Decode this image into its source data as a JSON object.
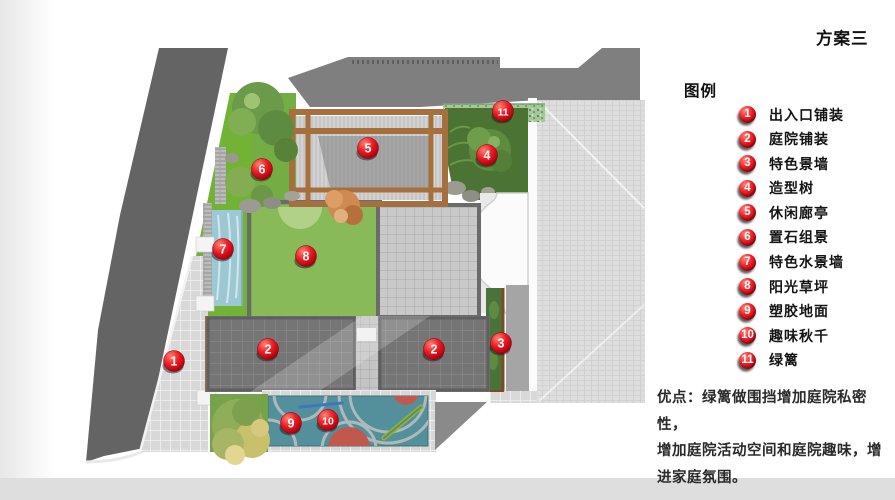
{
  "title": "方案三",
  "legend": {
    "heading": "图例",
    "items": [
      {
        "num": "1",
        "label": "出入口铺装"
      },
      {
        "num": "2",
        "label": "庭院铺装"
      },
      {
        "num": "3",
        "label": "特色景墙"
      },
      {
        "num": "4",
        "label": "造型树"
      },
      {
        "num": "5",
        "label": "休闲廊亭"
      },
      {
        "num": "6",
        "label": "置石组景"
      },
      {
        "num": "7",
        "label": "特色水景墙"
      },
      {
        "num": "8",
        "label": "阳光草坪"
      },
      {
        "num": "9",
        "label": "塑胶地面"
      },
      {
        "num": "10",
        "label": "趣味秋千"
      },
      {
        "num": "11",
        "label": "绿篱"
      }
    ]
  },
  "notes": {
    "lines": [
      "优点：绿篱做围挡增加庭院私密性，",
      "增加庭院活动空间和庭院趣味，增",
      "进家庭氛围。"
    ]
  },
  "plan": {
    "markers": [
      {
        "num": "1",
        "x": 174,
        "y": 361
      },
      {
        "num": "2",
        "x": 268,
        "y": 349
      },
      {
        "num": "2",
        "x": 434,
        "y": 349
      },
      {
        "num": "3",
        "x": 501,
        "y": 343
      },
      {
        "num": "4",
        "x": 487,
        "y": 155
      },
      {
        "num": "5",
        "x": 368,
        "y": 148
      },
      {
        "num": "6",
        "x": 262,
        "y": 169
      },
      {
        "num": "7",
        "x": 223,
        "y": 249
      },
      {
        "num": "8",
        "x": 306,
        "y": 256
      },
      {
        "num": "9",
        "x": 291,
        "y": 423
      },
      {
        "num": "10",
        "x": 328,
        "y": 420
      },
      {
        "num": "11",
        "x": 503,
        "y": 111
      }
    ]
  },
  "colors": {
    "marker_red": "#ee1c24",
    "lawn_green": "#88ba58",
    "strip_green": "#72b335",
    "bed_green": "#4a7334",
    "water_blue": "#9cc8d4",
    "play_teal": "#53909b",
    "play_red": "#c05a50",
    "road_gray": "#646464",
    "building_gray": "#7f7f7f",
    "roof_gray": "#dedede",
    "wood_brown": "#a5703e"
  }
}
